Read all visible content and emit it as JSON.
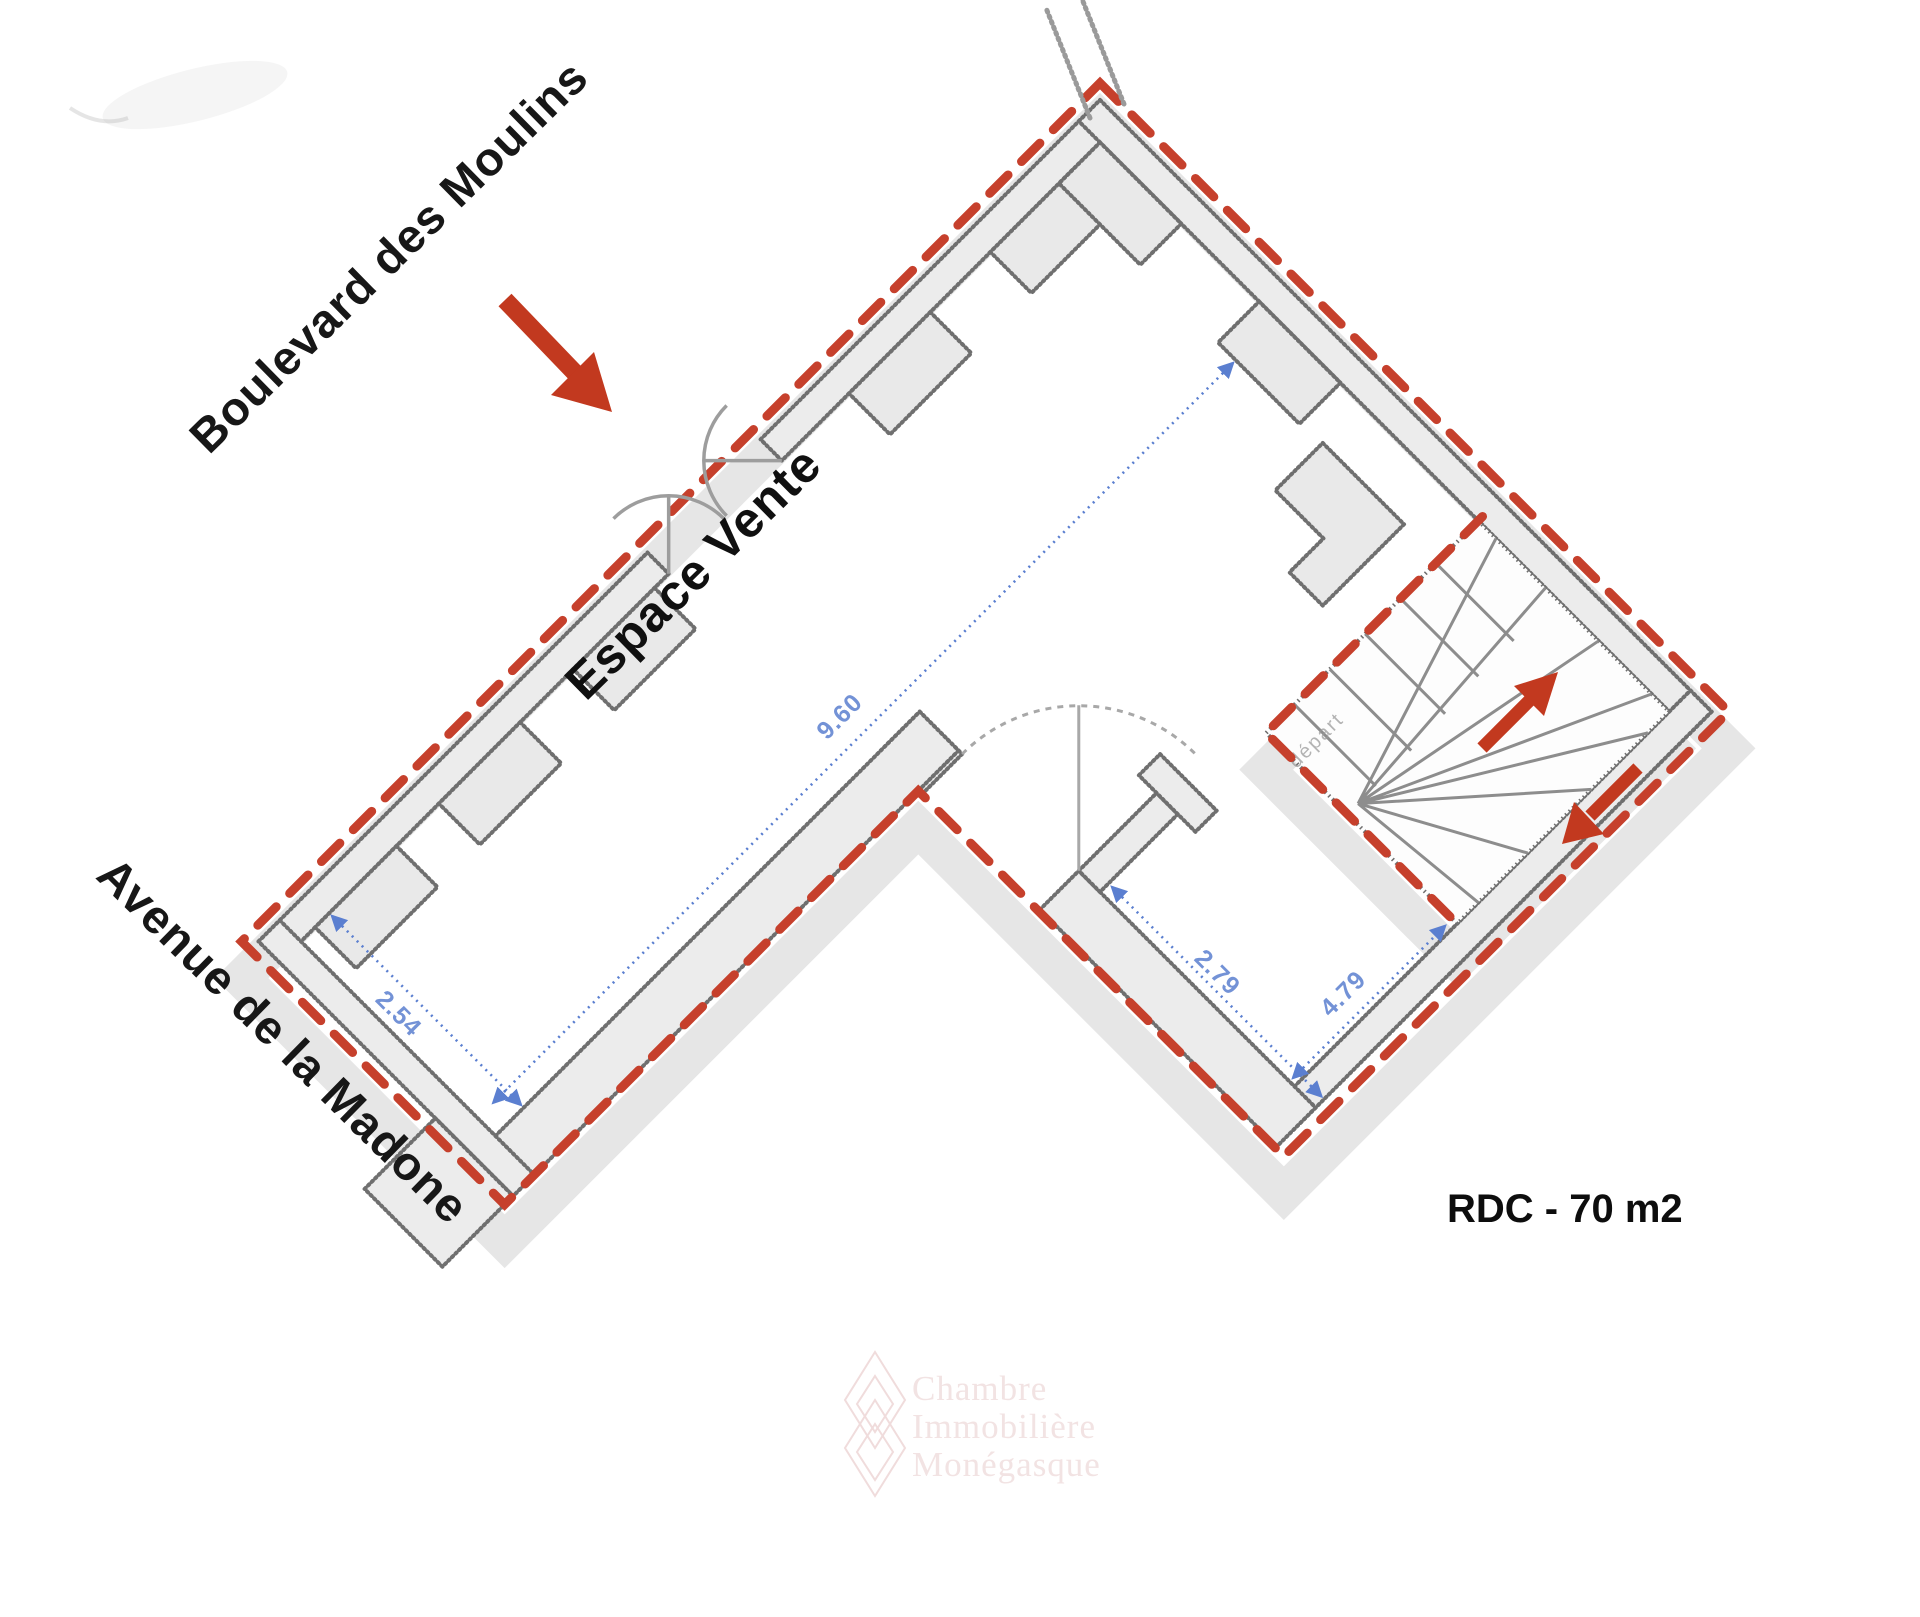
{
  "plan": {
    "street_top": "Boulevard des Moulins",
    "street_left": "Avenue de la Madone",
    "room_label": "Espace Vente",
    "floor_area_label": "RDC - 70 m2",
    "stairs_note": "départ",
    "dimensions": {
      "sales_length_m": "9.60",
      "sales_width_m": "2.54",
      "back_width_m": "2.79",
      "back_length_m": "4.79"
    },
    "watermark": [
      "Chambre",
      "Immobilière",
      "Monégasque"
    ],
    "colors": {
      "arrow_red": "#c2391f",
      "boundary_red": "#c6402c",
      "dimension_blue": "#5b7fd0",
      "wall_gray": "#6f6f6f",
      "pier_fill": "#e9e9e9",
      "shadow_gray": "#e2e2e2"
    }
  }
}
